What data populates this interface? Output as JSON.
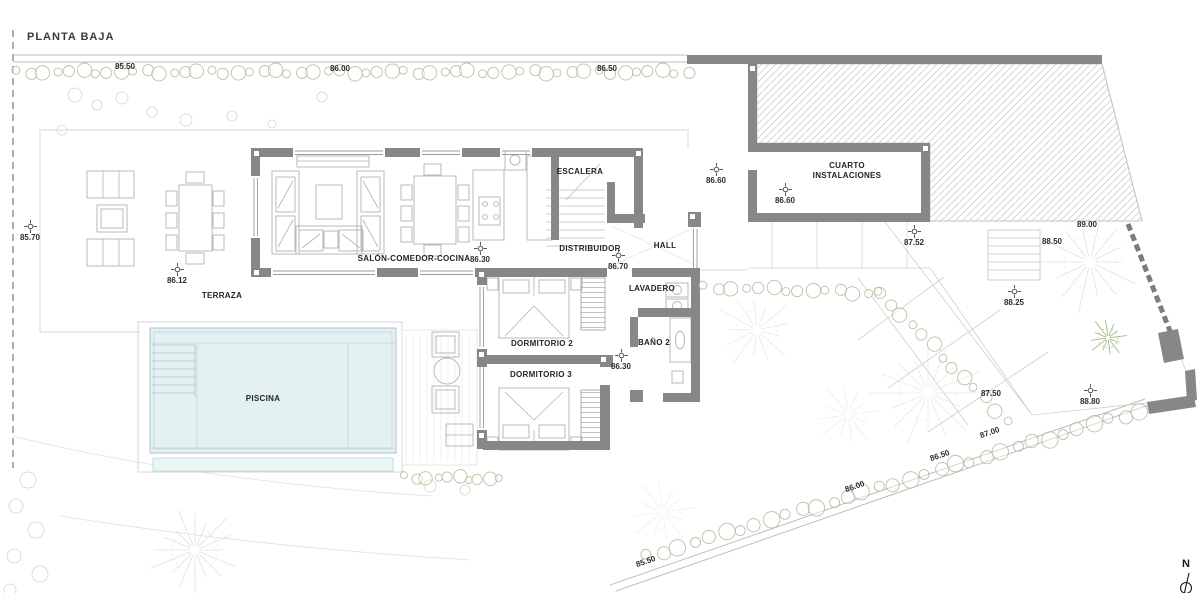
{
  "title": "PLANTA BAJA",
  "rooms": {
    "escalera": "ESCALERA",
    "cuarto_instalaciones": "CUARTO INSTALACIONES",
    "distribuidor": "DISTRIBUIDOR",
    "hall": "HALL",
    "salon_comedor_cocina": "SALÓN-COMEDOR-COCINA",
    "terraza": "TERRAZA",
    "lavadero": "LAVADERO",
    "dormitorio2": "DORMITORIO 2",
    "dormitorio3": "DORMITORIO 3",
    "bano2": "BAÑO 2",
    "piscina": "PISCINA"
  },
  "levels": {
    "top_85_50": "85.50",
    "top_86_00": "86.00",
    "top_86_50": "86.50",
    "west_85_70": "85.70",
    "terraza_86_12": "86.12",
    "salon_86_30": "86.30",
    "hall_86_60": "86.60",
    "cuarto_86_60": "86.60",
    "distribuidor_86_70": "86.70",
    "dormitorios_86_30": "86.30",
    "garden_87_52": "87.52",
    "garden_88_50": "88.50",
    "garden_89_00": "89.00",
    "garden_88_25": "88.25",
    "garden_87_50": "87.50",
    "garden_88_80": "88.80",
    "boundary_87_00": "87.00",
    "boundary_86_50": "86.50",
    "boundary_86_00": "86.00",
    "boundary_85_50": "85.50"
  },
  "compass": {
    "north": "N"
  },
  "colors": {
    "wall": "#878787",
    "pool_water": "#e4f1f3",
    "vegetation": "#a9bc93"
  }
}
